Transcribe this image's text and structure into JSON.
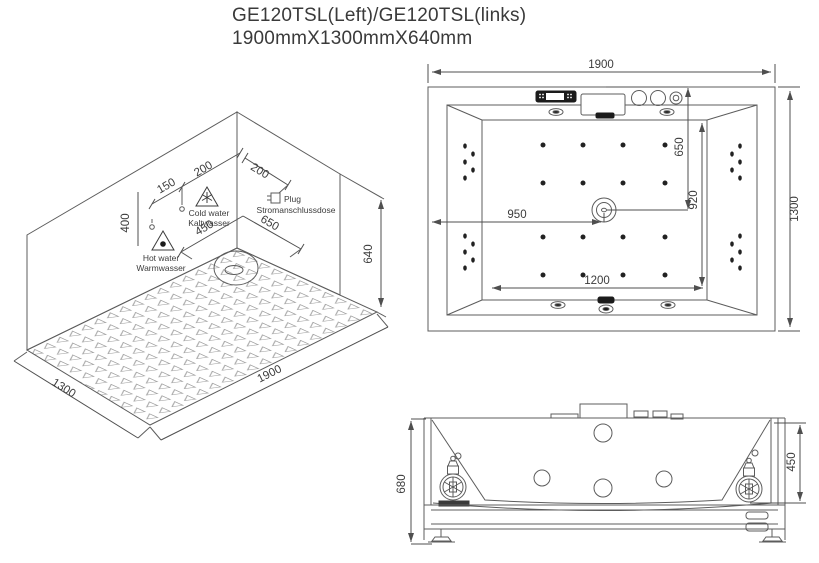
{
  "title": {
    "line1": "GE120TSL(Left)/GE120TSL(links)",
    "line2": "1900mmX1300mmX640mm"
  },
  "isometric_view": {
    "dims": {
      "back_left_200": "200",
      "back_left_150": "150",
      "back_left_400": "400",
      "back_right_200": "200",
      "floor_450": "450",
      "floor_650": "650",
      "height_640": "640",
      "width_1300": "1300",
      "length_1900": "1900"
    },
    "labels": {
      "cold_water_en": "Cold water",
      "cold_water_de": "Kaltwasser",
      "hot_water_en": "Hot water",
      "hot_water_de": "Warmwasser",
      "plug_en": "Plug",
      "plug_de": "Stromanschlussdose"
    }
  },
  "top_view": {
    "dims": {
      "overall_length": "1900",
      "overall_width": "1300",
      "drain_from_left": "950",
      "drain_from_top": "650",
      "inner_width": "920",
      "inner_length": "1200"
    }
  },
  "front_view": {
    "dims": {
      "overall_height": "680",
      "inner_depth": "450"
    }
  }
}
